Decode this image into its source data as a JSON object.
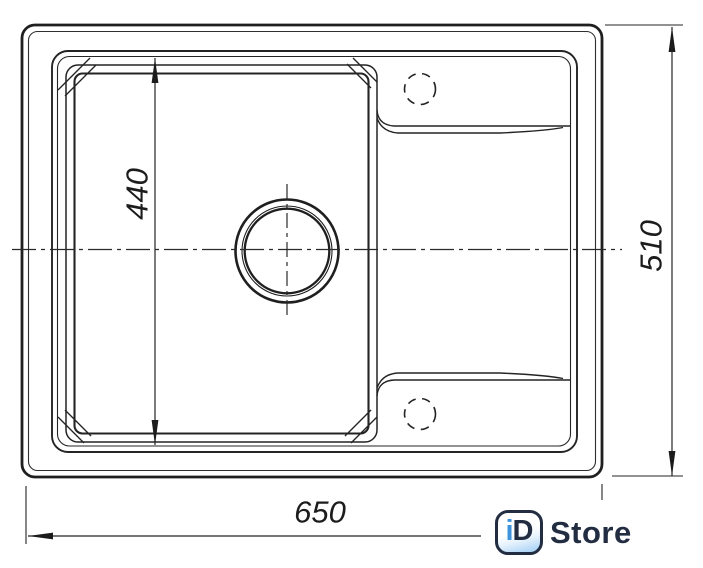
{
  "drawing": {
    "type": "technical-dimension-drawing",
    "subject": "kitchen sink with bowl and drainer, top view",
    "dimensions": {
      "overall_width": "650",
      "overall_depth": "510",
      "bowl_inner": "440"
    },
    "line_color": "#262626",
    "background_color": "#ffffff"
  },
  "logo": {
    "badge_i": "i",
    "badge_d": "D",
    "store_text": "Store",
    "navy_color": "#232d42",
    "blue_color": "#3f93dd"
  }
}
